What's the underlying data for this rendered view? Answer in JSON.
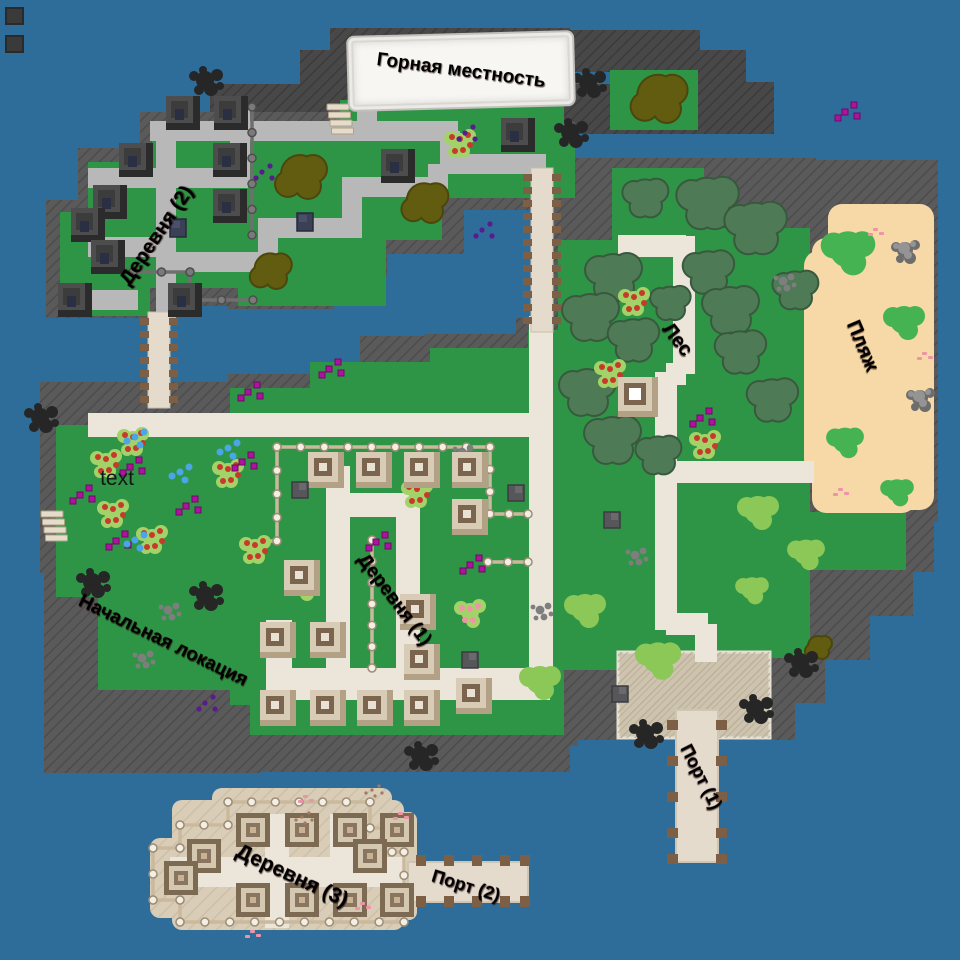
{
  "labels": {
    "mountain": {
      "text": "Горная местность"
    },
    "village2": {
      "text": "Деревня (2)"
    },
    "forest": {
      "text": "Лес"
    },
    "beach": {
      "text": "Пляж"
    },
    "note": {
      "text": "text"
    },
    "start": {
      "text": "Начальная локация"
    },
    "village1": {
      "text": "Деревня (1)"
    },
    "port1": {
      "text": "Порт (1)"
    },
    "village3": {
      "text": "Деревня (3)"
    },
    "port2": {
      "text": "Порт (2)"
    }
  },
  "palette": {
    "water": "#2e6c99",
    "grass": "#2f9546",
    "cliff": "#5a5a5a",
    "cliff_line": "#4c4c4c",
    "cliff_dark": "#484848",
    "cliff_dark_line": "#3b3b3b",
    "sand": "#f6d9a6",
    "island_sand": "#d9cdb8",
    "island_sand_line": "#ccc0a8",
    "dock": "#cdc3ae",
    "dock_line": "#bcb199",
    "path": "#ece6da",
    "road": "#b8b8b8",
    "plank": "#e4dbcd",
    "post_brown": "#7c5f45",
    "fence_tan": "#cbb99d",
    "fence_post": "#f4efe5",
    "fence_metal": "#6f6f6f",
    "label_red": "#9b100e",
    "banner_bg": "#f7f6f3",
    "tree": "#4e7b55",
    "tree_stroke": "#39593f",
    "olive": "#615c10",
    "olive_stroke": "#4b470c",
    "bush_green": "#46b352",
    "bush_light": "#8cc857",
    "berry_red": "#c53a2b",
    "flower_pink": "#ef93a8",
    "berry_leaf": "#a3d368",
    "magenta": "#ae12a0",
    "blue_dot": "#4aa5ea",
    "purple_dot": "#5a1b8e",
    "pebble": "#7e7e7e",
    "rock_black": "#262626",
    "rock_gray": "#949494"
  },
  "features": {
    "trees": [
      [
        707,
        203,
        1.1
      ],
      [
        755,
        228,
        1.1
      ],
      [
        613,
        277,
        1.0
      ],
      [
        708,
        272,
        0.9
      ],
      [
        590,
        317,
        1.0
      ],
      [
        633,
        340,
        0.9
      ],
      [
        730,
        310,
        1.0
      ],
      [
        740,
        352,
        0.9
      ],
      [
        587,
        392,
        1.0
      ],
      [
        612,
        440,
        1.0
      ],
      [
        658,
        455,
        0.8
      ],
      [
        772,
        400,
        0.9
      ],
      [
        795,
        290,
        0.8
      ],
      [
        670,
        303,
        0.7
      ],
      [
        645,
        198,
        0.8
      ]
    ],
    "olives": [
      [
        300,
        178,
        1.0
      ],
      [
        424,
        204,
        0.9
      ],
      [
        270,
        272,
        0.8
      ],
      [
        658,
        100,
        1.1
      ],
      [
        818,
        648,
        0.5
      ]
    ],
    "bushes": [
      [
        848,
        252,
        1.3,
        "g"
      ],
      [
        904,
        322,
        1.0,
        "g"
      ],
      [
        845,
        442,
        0.9,
        "g"
      ],
      [
        897,
        492,
        0.8,
        "g"
      ],
      [
        758,
        512,
        1.0,
        "l"
      ],
      [
        806,
        554,
        0.9,
        "l"
      ],
      [
        752,
        590,
        0.8,
        "l"
      ],
      [
        585,
        610,
        1.0,
        "l"
      ],
      [
        540,
        682,
        1.0,
        "l"
      ],
      [
        658,
        660,
        1.1,
        "l"
      ]
    ],
    "berries": [
      [
        106,
        462
      ],
      [
        113,
        512
      ],
      [
        133,
        440
      ],
      [
        152,
        538
      ],
      [
        228,
        472
      ],
      [
        255,
        548
      ],
      [
        417,
        492
      ],
      [
        460,
        142
      ],
      [
        634,
        300
      ],
      [
        610,
        372
      ],
      [
        705,
        443
      ]
    ],
    "pinks": [
      [
        304,
        585
      ],
      [
        470,
        612
      ]
    ],
    "magenta": [
      [
        80,
        495
      ],
      [
        116,
        541
      ],
      [
        130,
        467
      ],
      [
        186,
        506
      ],
      [
        242,
        462
      ],
      [
        376,
        542
      ],
      [
        470,
        565
      ],
      [
        329,
        369
      ],
      [
        248,
        392
      ],
      [
        700,
        418
      ],
      [
        845,
        112
      ]
    ],
    "blues": [
      [
        135,
        437
      ],
      [
        180,
        472
      ],
      [
        135,
        540
      ],
      [
        228,
        448
      ]
    ],
    "purples": [
      [
        482,
        230
      ],
      [
        465,
        133
      ],
      [
        205,
        703
      ],
      [
        262,
        172
      ]
    ],
    "pebbles": [
      [
        635,
        555
      ],
      [
        540,
        610
      ],
      [
        168,
        610
      ],
      [
        142,
        658
      ],
      [
        783,
        281
      ],
      [
        462,
        452
      ]
    ],
    "rocks_black": [
      [
        205,
        80
      ],
      [
        588,
        82
      ],
      [
        570,
        132
      ],
      [
        40,
        417
      ],
      [
        645,
        733
      ],
      [
        755,
        708
      ],
      [
        420,
        755
      ],
      [
        800,
        662
      ],
      [
        205,
        595
      ],
      [
        92,
        582
      ]
    ],
    "rocks_gray": [
      [
        905,
        250
      ],
      [
        920,
        398
      ]
    ],
    "buildings_v1": [
      [
        326,
        470
      ],
      [
        374,
        470
      ],
      [
        422,
        470
      ],
      [
        470,
        470
      ],
      [
        470,
        517
      ],
      [
        302,
        578
      ],
      [
        418,
        612
      ],
      [
        278,
        640
      ],
      [
        328,
        640
      ],
      [
        422,
        662
      ],
      [
        278,
        708
      ],
      [
        328,
        708
      ],
      [
        375,
        708
      ],
      [
        422,
        708
      ],
      [
        474,
        696
      ]
    ],
    "buildings_v2": [
      [
        183,
        113
      ],
      [
        231,
        113
      ],
      [
        136,
        160
      ],
      [
        230,
        160
      ],
      [
        398,
        166
      ],
      [
        110,
        202
      ],
      [
        230,
        206
      ],
      [
        88,
        225
      ],
      [
        108,
        257
      ],
      [
        75,
        300
      ],
      [
        185,
        300
      ],
      [
        518,
        135
      ]
    ],
    "buildings_v3": [
      [
        253,
        830
      ],
      [
        302,
        830
      ],
      [
        350,
        830
      ],
      [
        397,
        830
      ],
      [
        204,
        856
      ],
      [
        370,
        856
      ],
      [
        253,
        900
      ],
      [
        302,
        900
      ],
      [
        350,
        900
      ],
      [
        397,
        900
      ],
      [
        181,
        878
      ]
    ],
    "building_forest": [
      638,
      397
    ],
    "crates_gray": [
      [
        516,
        493
      ],
      [
        300,
        490
      ],
      [
        470,
        660
      ],
      [
        620,
        694
      ],
      [
        612,
        520
      ]
    ],
    "crates_navy": [
      [
        305,
        222
      ],
      [
        178,
        228
      ]
    ],
    "ladders": [
      [
        338,
        118
      ],
      [
        52,
        525
      ]
    ],
    "petals": [
      [
        303,
        795
      ],
      [
        360,
        902
      ],
      [
        250,
        930
      ],
      [
        398,
        812
      ],
      [
        873,
        228
      ],
      [
        922,
        352
      ],
      [
        838,
        488
      ]
    ],
    "speckles": [
      [
        302,
        817
      ],
      [
        372,
        790
      ]
    ],
    "corner_tiles": [
      [
        6,
        8
      ],
      [
        6,
        36
      ]
    ]
  }
}
